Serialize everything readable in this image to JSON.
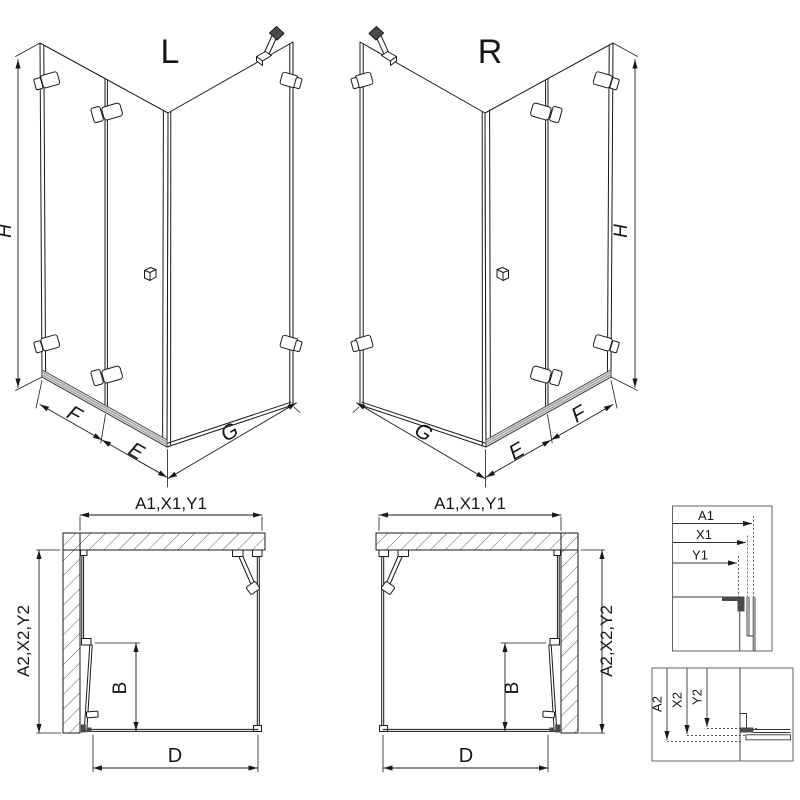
{
  "drawing": {
    "iso_left": {
      "title": "L",
      "dim_h": "H",
      "dim_f": "F",
      "dim_e": "E",
      "dim_g": "G"
    },
    "iso_right": {
      "title": "R",
      "dim_h": "H",
      "dim_f": "F",
      "dim_e": "E",
      "dim_g": "G"
    },
    "plan_left": {
      "dim_top": "A1,X1,Y1",
      "dim_side": "A2,X2,Y2",
      "dim_door": "B",
      "dim_bottom": "D"
    },
    "plan_right": {
      "dim_top": "A1,X1,Y1",
      "dim_side": "A2,X2,Y2",
      "dim_door": "B",
      "dim_bottom": "D"
    },
    "detail_width": {
      "dim_a": "A1",
      "dim_x": "X1",
      "dim_y": "Y1"
    },
    "detail_depth": {
      "dim_a": "A2",
      "dim_x": "X2",
      "dim_y": "Y2"
    },
    "colors": {
      "line": "#1a1a1a",
      "rail_fill": "#d9d9d9",
      "dark": "#4a4a4a",
      "background": "#ffffff"
    }
  }
}
